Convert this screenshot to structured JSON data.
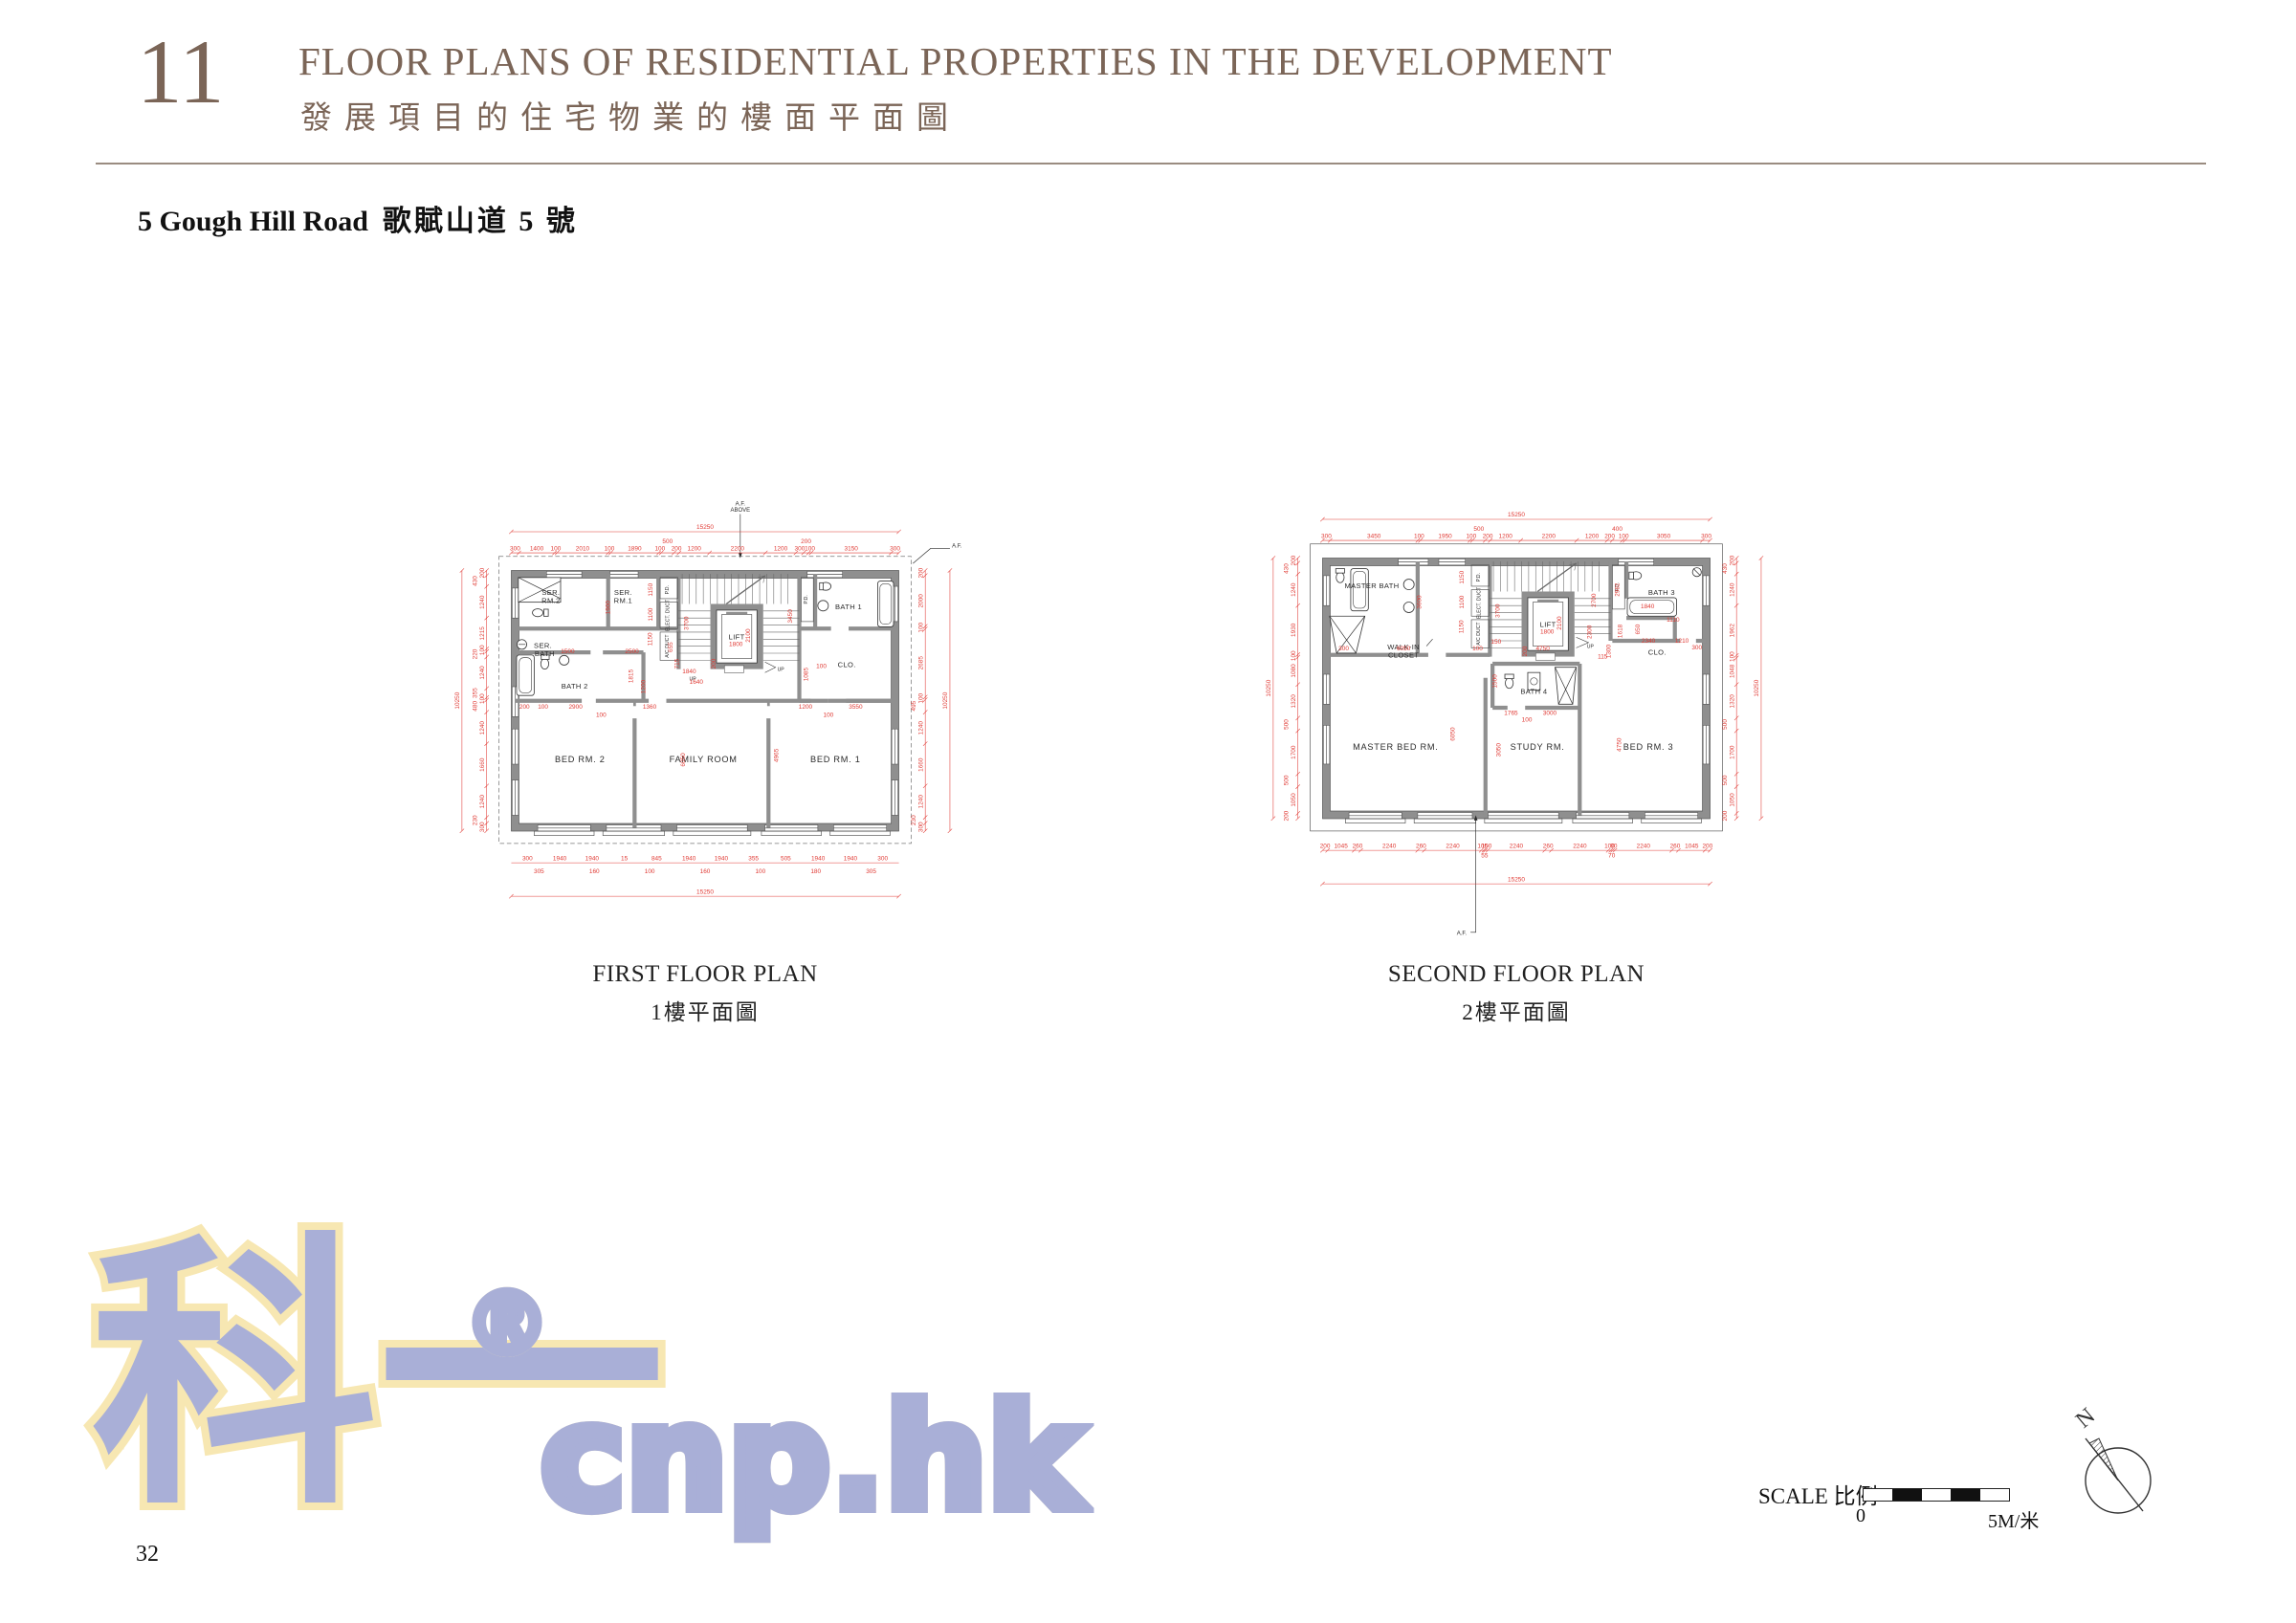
{
  "colors": {
    "accent_red": "#e03a34",
    "wall_gray": "#8f8f8f",
    "header_brown": "#7b6557",
    "watermark_fill": "#a9afd7",
    "watermark_outline": "#f7e7b2"
  },
  "header": {
    "section_no": "11",
    "title_en": "FLOOR PLANS OF RESIDENTIAL PROPERTIES IN THE DEVELOPMENT",
    "title_zh": "發展項目的住宅物業的樓面平面圖"
  },
  "subtitle": {
    "address_en": "5 Gough Hill Road",
    "address_zh": "歌賦山道 5 號"
  },
  "plan1": {
    "caption_en": "FIRST FLOOR PLAN",
    "caption_zh": "1樓平面圖",
    "af": "A.F.",
    "af_above_1": "A.F.",
    "af_above_2": "ABOVE",
    "total": [
      "15250"
    ],
    "total_v": [
      "10250"
    ],
    "dim_top": [
      "300",
      "1400",
      "100",
      "2010",
      "100",
      "1890",
      "100",
      "500",
      "200",
      "1200",
      "2200",
      "1200",
      "300",
      "200",
      "100",
      "3150",
      "300"
    ],
    "dim_bottom": [
      "300",
      "1940",
      "1940",
      "15",
      "845",
      "1940",
      "1940",
      "355",
      "505",
      "1940",
      "1940",
      "300"
    ],
    "dim_bottom2": [
      "305",
      "160",
      "100",
      "160",
      "100",
      "180",
      "305"
    ],
    "dim_left": [
      "200",
      "430",
      "1240",
      "1215",
      "100",
      "220",
      "1240",
      "355",
      "100",
      "480",
      "1240",
      "1660",
      "1240",
      "230",
      "300"
    ],
    "dim_right": [
      "200",
      "2000",
      "100",
      "2685",
      "100",
      "495",
      "1240",
      "1660",
      "1240",
      "230",
      "300"
    ],
    "interior": [
      "1900",
      "1150",
      "1100",
      "1150",
      "655",
      "1500",
      "2500",
      "715",
      "1815",
      "1200",
      "3700",
      "3450",
      "2100",
      "1800",
      "200",
      "1840",
      "1085",
      "100",
      "1640",
      "2900",
      "100",
      "1360",
      "6050",
      "4965",
      "1200",
      "100",
      "3550",
      "200",
      "100"
    ],
    "rooms": {
      "ser_rm2": [
        "SER.",
        "RM.2"
      ],
      "ser_rm1": [
        "SER.",
        "RM.1"
      ],
      "ser_bath": [
        "SER.",
        "BATH"
      ],
      "bath1": "BATH 1",
      "bath2": "BATH 2",
      "clo": "CLO.",
      "bed2": "BED RM. 2",
      "family": "FAMILY ROOM",
      "bed1": "BED RM. 1",
      "lift": "LIFT",
      "pd_a": "P.D.",
      "pd_b": "P.D.",
      "elect": "ELECT. DUCT",
      "ac": "A/C DUCT",
      "up1": "UP",
      "up2": "UP"
    }
  },
  "plan2": {
    "caption_en": "SECOND FLOOR PLAN",
    "caption_zh": "2樓平面圖",
    "af": "A.F.",
    "total": [
      "15250"
    ],
    "total_v": [
      "10250"
    ],
    "dim_top": [
      "300",
      "3450",
      "100",
      "1950",
      "100",
      "500",
      "200",
      "1200",
      "2200",
      "1200",
      "200",
      "400",
      "100",
      "3050",
      "300"
    ],
    "dim_bottom": [
      "200",
      "1045",
      "260",
      "2240",
      "260",
      "2240",
      "105",
      "55",
      "100",
      "2240",
      "260",
      "2240",
      "100",
      "70",
      "90",
      "2240",
      "260",
      "1045",
      "200"
    ],
    "dim_left": [
      "200",
      "430",
      "1240",
      "1930",
      "100",
      "1080",
      "1320",
      "500",
      "1700",
      "500",
      "1050",
      "200"
    ],
    "dim_right": [
      "200",
      "430",
      "1240",
      "1962",
      "100",
      "1048",
      "1320",
      "500",
      "1700",
      "500",
      "1050",
      "200"
    ],
    "interior": [
      "3600",
      "1150",
      "1100",
      "1150",
      "3700",
      "2700",
      "2982",
      "2100",
      "1800",
      "200",
      "1840",
      "1110",
      "1618",
      "650",
      "2340",
      "1210",
      "300",
      "1300",
      "115",
      "2300",
      "300",
      "6050",
      "100",
      "4750",
      "1500",
      "1765",
      "3000",
      "100",
      "3050",
      "6050",
      "4750",
      "150"
    ],
    "rooms": {
      "master_bath": "MASTER  BATH",
      "walk_in": [
        "WALK-IN",
        "CLOSET"
      ],
      "bath3": "BATH 3",
      "bath4": "BATH 4",
      "clo": "CLO.",
      "master_bed": "MASTER BED RM.",
      "study": "STUDY RM.",
      "bed3": "BED RM. 3",
      "lift": "LIFT",
      "pd_a": "P.D.",
      "pd_b": "P.D.",
      "elect": "ELECT. DUCT",
      "ac": "A/C DUCT",
      "up": "UP"
    }
  },
  "scalebar": {
    "label": "SCALE 比例",
    "zero": "0",
    "five": "5M/米"
  },
  "compass": {
    "north": "N"
  },
  "watermark": {
    "cn": "科一",
    "reg": "®",
    "domain": "cnp.hk"
  },
  "page": {
    "number": "32"
  }
}
